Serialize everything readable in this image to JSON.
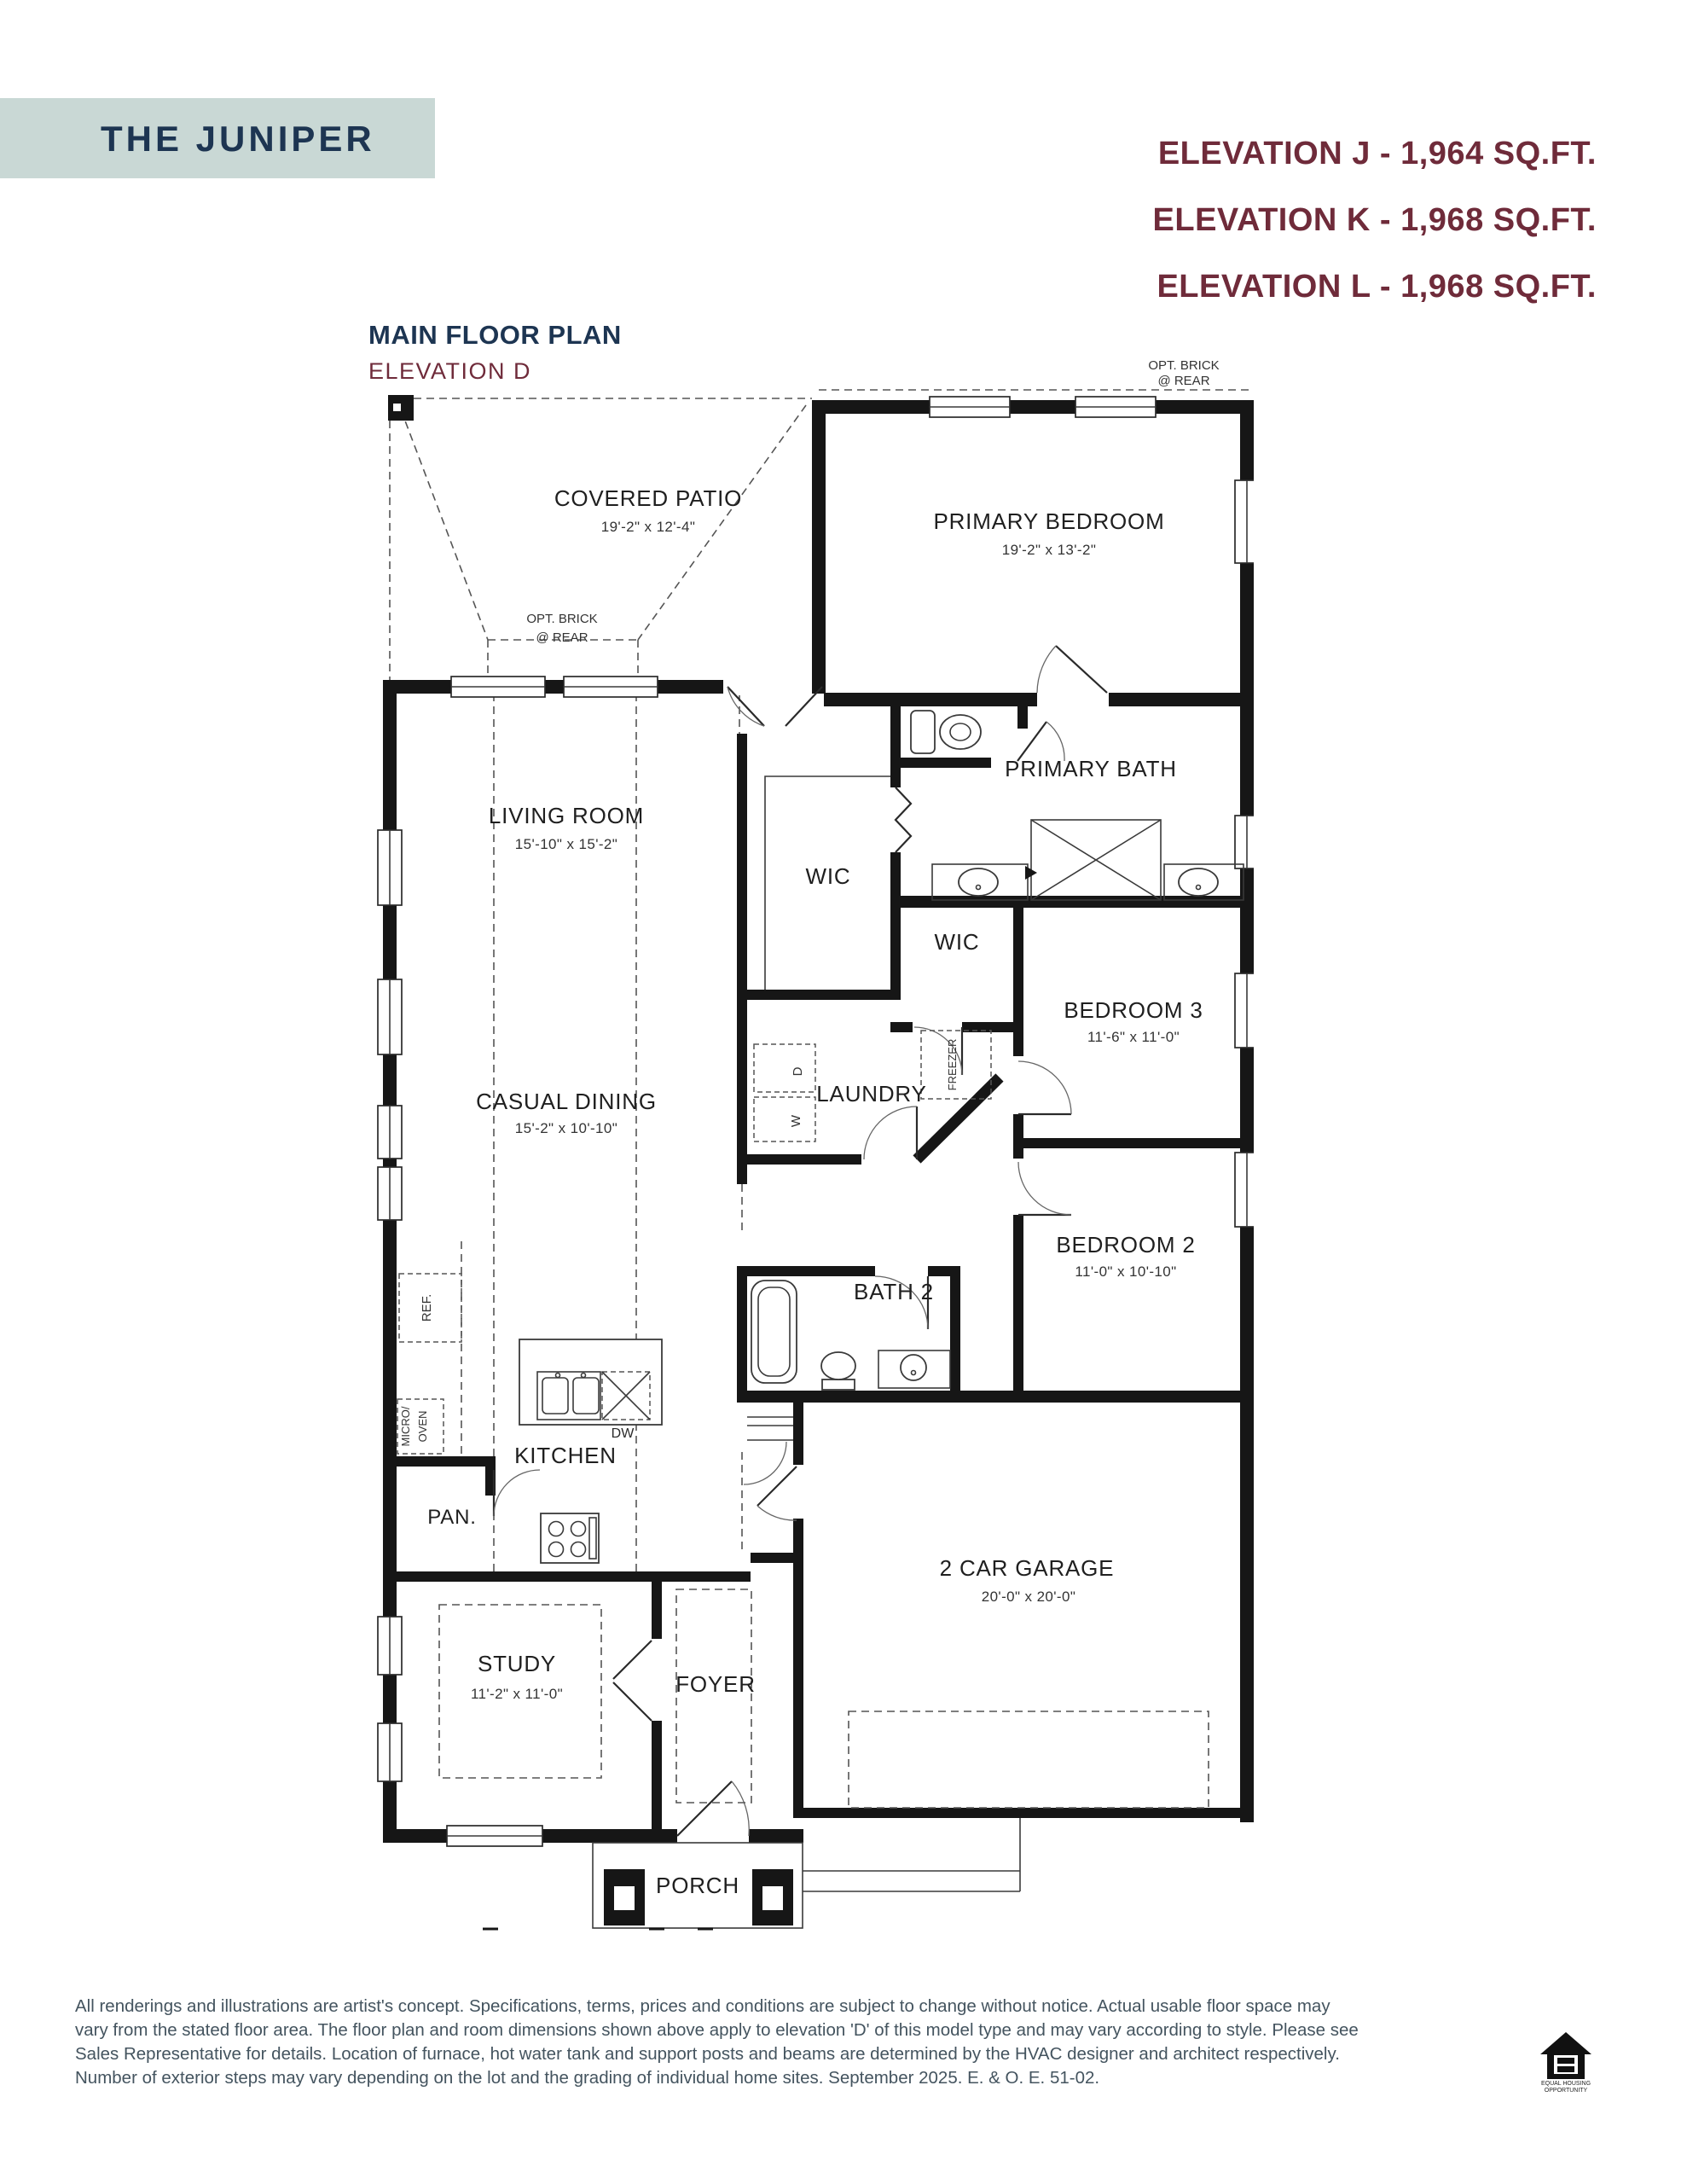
{
  "header": {
    "title": "THE JUNIPER",
    "elevations": [
      "ELEVATION J - 1,964 SQ.FT.",
      "ELEVATION K - 1,968 SQ.FT.",
      "ELEVATION L - 1,968 SQ.FT."
    ]
  },
  "plan_heading": {
    "title": "MAIN FLOOR PLAN",
    "subtitle": "ELEVATION D"
  },
  "colors": {
    "title_box": "#c9d8d5",
    "navy": "#1d3552",
    "burgundy": "#6f2b3a",
    "footer_text": "#44545f",
    "plan_line": "#161616"
  },
  "floor_plan": {
    "rooms": [
      {
        "id": "covered-patio",
        "name": "COVERED PATIO",
        "dims": "19'-2\" x 12'-4\""
      },
      {
        "id": "primary-bedroom",
        "name": "PRIMARY BEDROOM",
        "dims": "19'-2\" x 13'-2\""
      },
      {
        "id": "living-room",
        "name": "LIVING ROOM",
        "dims": "15'-10\" x 15'-2\""
      },
      {
        "id": "primary-bath",
        "name": "PRIMARY BATH"
      },
      {
        "id": "wic-1",
        "name": "WIC"
      },
      {
        "id": "wic-2",
        "name": "WIC"
      },
      {
        "id": "bedroom-3",
        "name": "BEDROOM 3",
        "dims": "11'-6\" x 11'-0\""
      },
      {
        "id": "casual-dining",
        "name": "CASUAL DINING",
        "dims": "15'-2\" x 10'-10\""
      },
      {
        "id": "laundry",
        "name": "LAUNDRY"
      },
      {
        "id": "bedroom-2",
        "name": "BEDROOM 2",
        "dims": "11'-0\" x 10'-10\""
      },
      {
        "id": "bath-2",
        "name": "BATH 2"
      },
      {
        "id": "kitchen",
        "name": "KITCHEN"
      },
      {
        "id": "pantry",
        "name": "PAN."
      },
      {
        "id": "garage",
        "name": "2 CAR GARAGE",
        "dims": "20'-0\" x 20'-0\""
      },
      {
        "id": "study",
        "name": "STUDY",
        "dims": "11'-2\" x 11'-0\""
      },
      {
        "id": "foyer",
        "name": "FOYER"
      },
      {
        "id": "porch",
        "name": "PORCH"
      }
    ],
    "appliances": {
      "dw": "DW",
      "ref": "REF.",
      "micro_line1": "MICRO/",
      "micro_line2": "OVEN",
      "washer": "W",
      "dryer": "D",
      "freezer": "FREEZER"
    },
    "notes": {
      "opt_brick_line1": "OPT. BRICK",
      "opt_brick_line2": "@ REAR"
    }
  },
  "footer": {
    "lines": [
      "All renderings and illustrations are artist's concept. Specifications, terms, prices and conditions are subject to change without notice. Actual usable floor space may",
      "vary from the stated floor area. The floor plan and room dimensions shown above apply to elevation 'D' of this model type and may vary according to style. Please see",
      "Sales Representative for details. Location of furnace, hot water tank and support posts and beams are determined by the HVAC designer and architect respectively.",
      "Number of exterior steps may vary depending on the lot and the grading of individual home sites. September 2025. E. & O. E. 51-02."
    ]
  },
  "logo": {
    "name": "equal-housing-opportunity",
    "line1": "EQUAL HOUSING",
    "line2": "OPPORTUNITY"
  }
}
